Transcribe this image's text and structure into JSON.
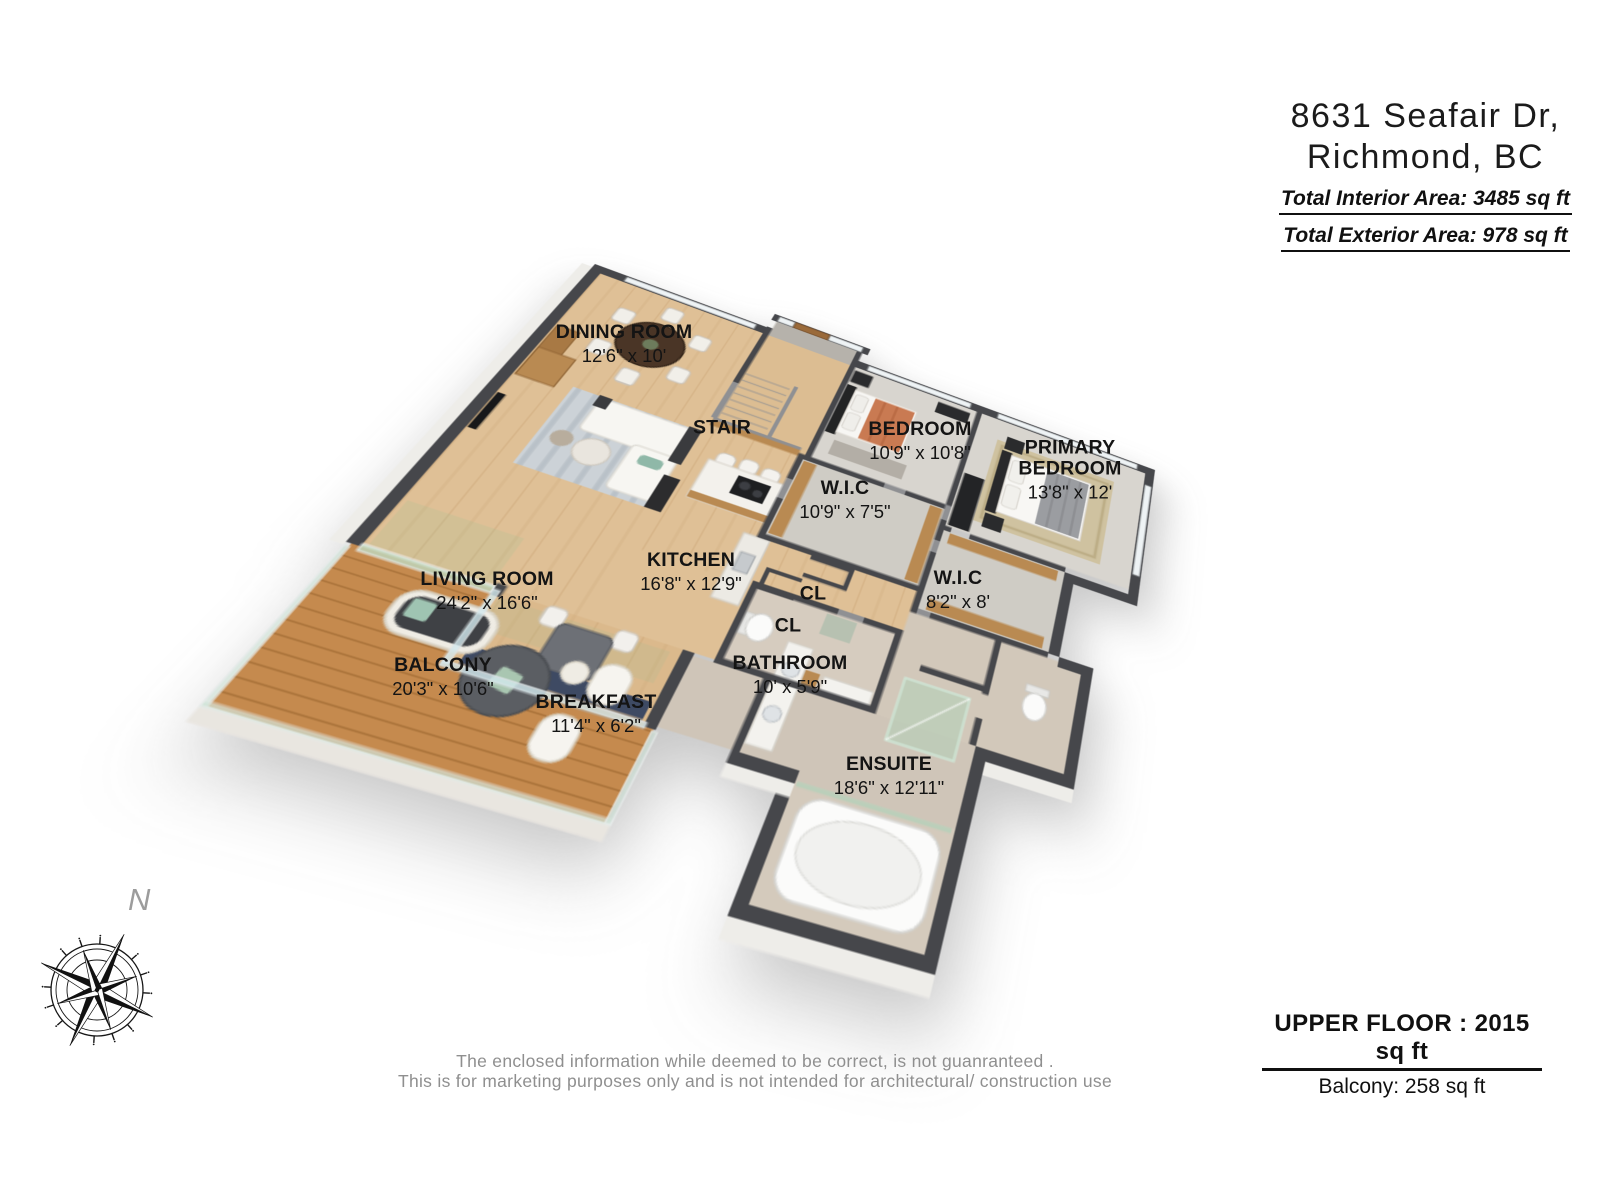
{
  "header": {
    "address_line1": "8631 Seafair Dr,",
    "address_line2": "Richmond, BC",
    "interior_area": "Total Interior Area: 3485 sq ft",
    "exterior_area": "Total Exterior Area: 978 sq ft"
  },
  "plan": {
    "rooms": [
      {
        "id": "dining",
        "name": "DINING ROOM",
        "dims": "12'6\" x 10'",
        "x": 624,
        "y": 344
      },
      {
        "id": "stair",
        "name": "STAIR",
        "dims": "",
        "x": 722,
        "y": 428
      },
      {
        "id": "bedroom",
        "name": "BEDROOM",
        "dims": "10'9\" x 10'8\"",
        "x": 920,
        "y": 441
      },
      {
        "id": "primary-bedroom",
        "name": "PRIMARY BEDROOM",
        "dims": "13'8\" x 12'",
        "x": 1070,
        "y": 470,
        "wrap": 150
      },
      {
        "id": "wic-bedroom",
        "name": "W.I.C",
        "dims": "10'9\" x 7'5\"",
        "x": 845,
        "y": 500
      },
      {
        "id": "kitchen",
        "name": "KITCHEN",
        "dims": "16'8\" x 12'9\"",
        "x": 691,
        "y": 572
      },
      {
        "id": "living-room",
        "name": "LIVING ROOM",
        "dims": "24'2\" x 16'6\"",
        "x": 487,
        "y": 591
      },
      {
        "id": "wic-primary",
        "name": "W.I.C",
        "dims": "8'2\" x 8'",
        "x": 958,
        "y": 590
      },
      {
        "id": "closet-1",
        "name": "CL",
        "dims": "",
        "x": 813,
        "y": 594
      },
      {
        "id": "closet-2",
        "name": "CL",
        "dims": "",
        "x": 788,
        "y": 626
      },
      {
        "id": "balcony",
        "name": "BALCONY",
        "dims": "20'3\" x 10'6\"",
        "x": 443,
        "y": 677
      },
      {
        "id": "bathroom",
        "name": "BATHROOM",
        "dims": "10' x 5'9\"",
        "x": 790,
        "y": 675
      },
      {
        "id": "breakfast",
        "name": "BREAKFAST",
        "dims": "11'4\" x 6'2\"",
        "x": 596,
        "y": 714
      },
      {
        "id": "ensuite",
        "name": "ENSUITE",
        "dims": "18'6\" x 12'11\"",
        "x": 889,
        "y": 776
      }
    ]
  },
  "compass": {
    "north_label": "N"
  },
  "footer": {
    "floor_area_label": "UPPER FLOOR : 2015 sq ft",
    "balcony_area_label": "Balcony: 258 sq ft",
    "disclaimer_line1": "The enclosed information while deemed to be correct, is not guanranteed .",
    "disclaimer_line2": "This is for marketing purposes only and is not intended for architectural/ construction use"
  },
  "colors": {
    "wall_dark": "#46474b",
    "wall_mid": "#8f9093",
    "floor_wood": "#dfc096",
    "deck_wood": "#c58a4e",
    "carpet": "#d8d5cf",
    "tile": "#d3c9bc",
    "glass": "#bed8c6",
    "label_text": "#141414",
    "disclaimer_text": "#8f8f8f"
  }
}
